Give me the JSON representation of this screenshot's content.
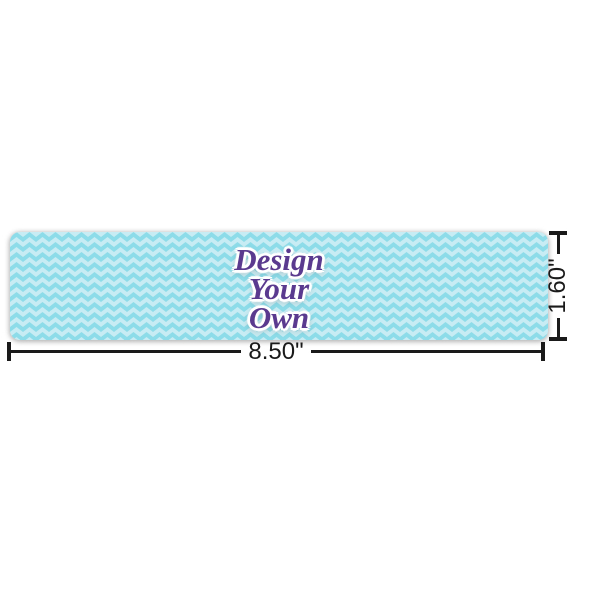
{
  "preview": {
    "label_lines": [
      "Design",
      "Your",
      "Own"
    ],
    "dimensions": {
      "width_label": "8.50\"",
      "height_label": "1.60\""
    },
    "colors": {
      "background": "#ffffff",
      "pattern_base": "#c8ecf3",
      "pattern_chevron": "#8ddce9",
      "text_fill": "#5a3a8e",
      "text_outline": "#ffffff",
      "dimension_line": "#1a1a1a"
    }
  }
}
